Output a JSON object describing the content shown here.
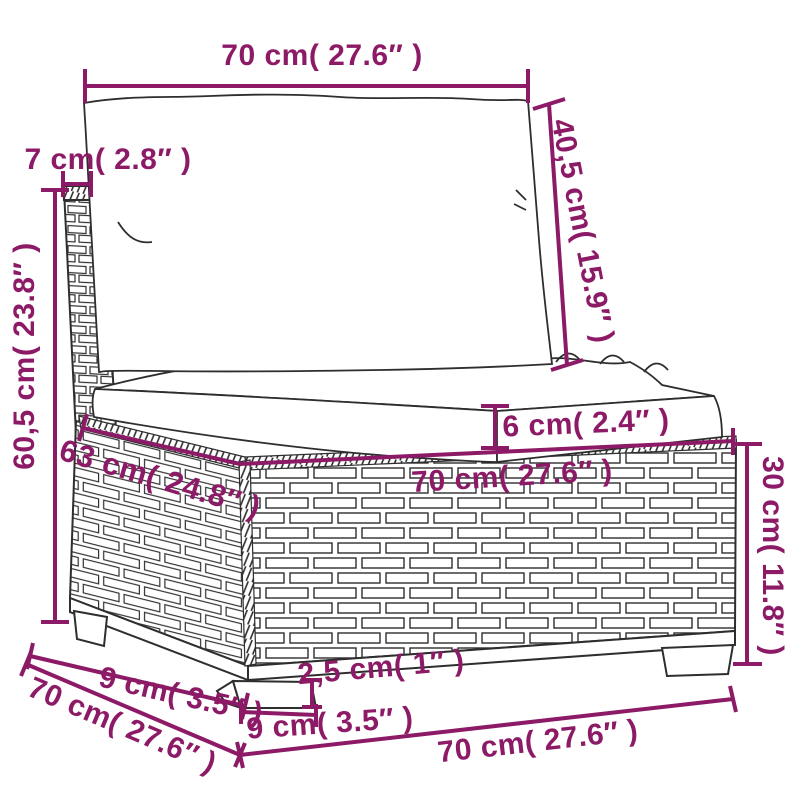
{
  "diagram": {
    "type": "furniture-dimension-drawing",
    "subject": "rattan middle sofa section with cushions",
    "colors": {
      "dimension_accent": "#8C1A66",
      "line_art": "#2e2e2e",
      "background": "#FFFFFF"
    }
  },
  "labels": {
    "back_cushion_width": "70 cm( 27.6″ )",
    "back_panel_thickness": "7 cm( 2.8″ )",
    "back_cushion_height": "40,5 cm( 15.9″ )",
    "overall_height": "60,5 cm( 23.8″ )",
    "seat_cushion_thickness": "6 cm( 2.4″ )",
    "seat_depth": "63 cm( 24.8″ )",
    "seat_width": "70 cm( 27.6″ )",
    "base_height": "30 cm( 11.8″ )",
    "leg_height": "2,5 cm( 1″ )",
    "leg_width": "9 cm( 3.5″ )",
    "leg_depth": "9 cm( 3.5″ )",
    "overall_depth": "70 cm( 27.6″ )",
    "overall_width": "70 cm( 27.6″ )"
  }
}
